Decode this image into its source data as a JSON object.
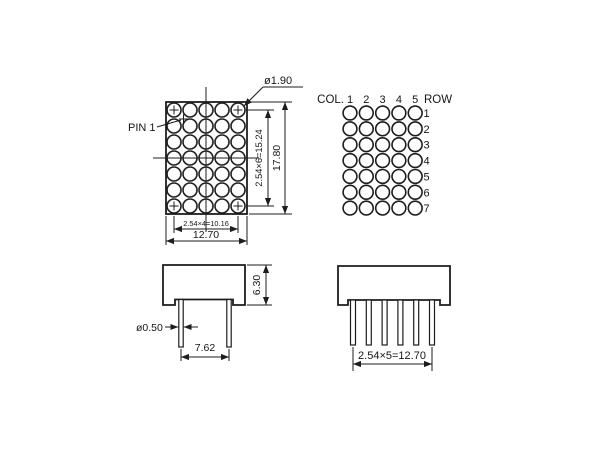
{
  "front_view": {
    "pin1_label": "PIN 1",
    "dot_diameter_label": "ø1.90",
    "row_pitch_label": "2.54×6=15.24",
    "height_label": "17.80",
    "col_pitch_label": "2.54×4=10.16",
    "width_label": "12.70",
    "grid": {
      "rows": 7,
      "cols": 5
    }
  },
  "pin_layout": {
    "col_header": "COL.",
    "row_header": "ROW",
    "col_labels": [
      "1",
      "2",
      "3",
      "4",
      "5"
    ],
    "row_labels": [
      "1",
      "2",
      "3",
      "4",
      "5",
      "6",
      "7"
    ],
    "grid": {
      "rows": 7,
      "cols": 5
    }
  },
  "side_view": {
    "height_label": "6.30",
    "pin_diameter_label": "ø0.50",
    "pin_pitch_label": "7.62",
    "pin_count": 2
  },
  "bottom_view": {
    "pin_pitch_label": "2.54×5=12.70",
    "pin_count": 6
  },
  "colors": {
    "line": "#1d1d1d",
    "background": "#ffffff"
  }
}
